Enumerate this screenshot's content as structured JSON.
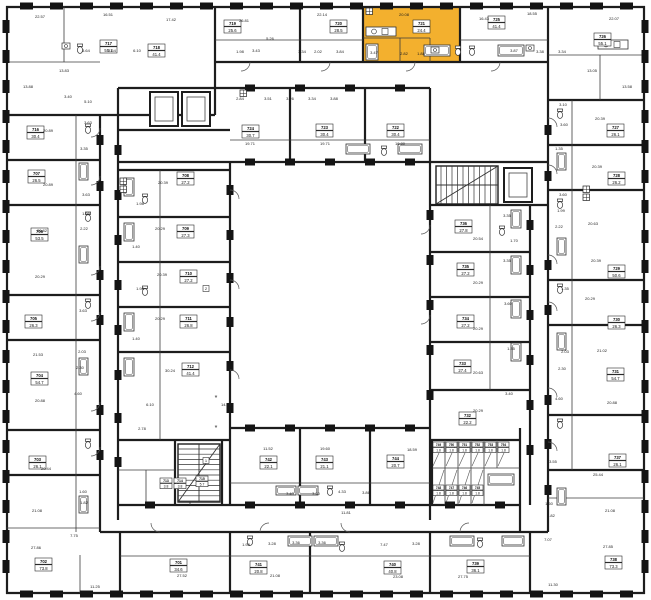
{
  "plan": {
    "type": "residential-floor-plan",
    "selected_unit": {
      "number": "721",
      "area": "24.4"
    },
    "colors": {
      "highlight": "#F3B02E",
      "wall": "#1d1d1d",
      "partition": "#3c3c3c",
      "pier": "#141414",
      "label_border": "#2a2a2a",
      "background": "#ffffff"
    },
    "units": [
      {
        "n": "717",
        "a": "55.1",
        "x": 100,
        "y": 40
      },
      {
        "n": "718",
        "a": "41.4",
        "x": 148,
        "y": 44
      },
      {
        "n": "719",
        "a": "25.6",
        "x": 224,
        "y": 20
      },
      {
        "n": "720",
        "a": "28.5",
        "x": 330,
        "y": 20
      },
      {
        "n": "721",
        "a": "24.4",
        "x": 413,
        "y": 20,
        "hl": 1
      },
      {
        "n": "725",
        "a": "41.4",
        "x": 488,
        "y": 16
      },
      {
        "n": "726",
        "a": "55.1",
        "x": 594,
        "y": 33
      },
      {
        "n": "727",
        "a": "26.1",
        "x": 607,
        "y": 124
      },
      {
        "n": "728",
        "a": "26.2",
        "x": 608,
        "y": 172
      },
      {
        "n": "729",
        "a": "50.6",
        "x": 608,
        "y": 265
      },
      {
        "n": "730",
        "a": "26.3",
        "x": 608,
        "y": 316
      },
      {
        "n": "731",
        "a": "54.7",
        "x": 607,
        "y": 368
      },
      {
        "n": "737",
        "a": "26.1",
        "x": 609,
        "y": 454
      },
      {
        "n": "738",
        "a": "73.3",
        "x": 605,
        "y": 556
      },
      {
        "n": "739",
        "a": "36.1",
        "x": 467,
        "y": 560
      },
      {
        "n": "740",
        "a": "40.8",
        "x": 384,
        "y": 561
      },
      {
        "n": "741",
        "a": "20.8",
        "x": 250,
        "y": 561
      },
      {
        "n": "701",
        "a": "34.6",
        "x": 170,
        "y": 559
      },
      {
        "n": "702",
        "a": "73.8",
        "x": 35,
        "y": 558
      },
      {
        "n": "703",
        "a": "26.1",
        "x": 29,
        "y": 456
      },
      {
        "n": "704",
        "a": "54.7",
        "x": 31,
        "y": 372
      },
      {
        "n": "705",
        "a": "26.3",
        "x": 25,
        "y": 315
      },
      {
        "n": "706",
        "a": "53.5",
        "x": 31,
        "y": 228
      },
      {
        "n": "707",
        "a": "26.5",
        "x": 28,
        "y": 170
      },
      {
        "n": "716",
        "a": "30.4",
        "x": 27,
        "y": 126
      },
      {
        "n": "724",
        "a": "30.7",
        "x": 242,
        "y": 125
      },
      {
        "n": "723",
        "a": "30.4",
        "x": 316,
        "y": 124
      },
      {
        "n": "722",
        "a": "30.4",
        "x": 387,
        "y": 124
      },
      {
        "n": "736",
        "a": "27.8",
        "x": 455,
        "y": 220
      },
      {
        "n": "735",
        "a": "27.2",
        "x": 457,
        "y": 263
      },
      {
        "n": "734",
        "a": "27.2",
        "x": 457,
        "y": 315
      },
      {
        "n": "733",
        "a": "27.4",
        "x": 454,
        "y": 360
      },
      {
        "n": "732",
        "a": "22.2",
        "x": 459,
        "y": 412
      },
      {
        "n": "708",
        "a": "27.2",
        "x": 177,
        "y": 172
      },
      {
        "n": "709",
        "a": "27.3",
        "x": 177,
        "y": 225
      },
      {
        "n": "710",
        "a": "27.2",
        "x": 180,
        "y": 270
      },
      {
        "n": "711",
        "a": "26.8",
        "x": 180,
        "y": 315
      },
      {
        "n": "712",
        "a": "41.4",
        "x": 182,
        "y": 363
      },
      {
        "n": "742",
        "a": "22.1",
        "x": 260,
        "y": 456
      },
      {
        "n": "743",
        "a": "21.1",
        "x": 316,
        "y": 456
      },
      {
        "n": "744",
        "a": "20.7",
        "x": 387,
        "y": 455
      },
      {
        "n": "713",
        "a": "3.8",
        "x": 160,
        "y": 478,
        "s": 1
      },
      {
        "n": "714",
        "a": "3.8",
        "x": 174,
        "y": 478,
        "s": 1
      },
      {
        "n": "715",
        "a": "5.7",
        "x": 196,
        "y": 476,
        "s": 1
      }
    ],
    "storage_units": [
      {
        "n": "749",
        "a": "1.8",
        "x": 433,
        "y": 442
      },
      {
        "n": "750",
        "a": "1.8",
        "x": 446,
        "y": 442
      },
      {
        "n": "751",
        "a": "1.8",
        "x": 459,
        "y": 442
      },
      {
        "n": "752",
        "a": "1.8",
        "x": 472,
        "y": 442
      },
      {
        "n": "753",
        "a": "1.8",
        "x": 485,
        "y": 442
      },
      {
        "n": "754",
        "a": "1.8",
        "x": 498,
        "y": 442
      },
      {
        "n": "748",
        "a": "1.8",
        "x": 433,
        "y": 485
      },
      {
        "n": "747",
        "a": "1.8",
        "x": 446,
        "y": 485
      },
      {
        "n": "746",
        "a": "1.8",
        "x": 459,
        "y": 485
      },
      {
        "n": "745",
        "a": "1.8",
        "x": 472,
        "y": 485
      }
    ],
    "rooms": [
      [
        "22.57",
        40,
        18
      ],
      [
        "16.51",
        108,
        16
      ],
      [
        "17.42",
        171,
        21
      ],
      [
        "26.81",
        244,
        22
      ],
      [
        "22.14",
        322,
        16
      ],
      [
        "20.08",
        404,
        16
      ],
      [
        "16.43",
        484,
        20
      ],
      [
        "18.55",
        532,
        15
      ],
      [
        "22.07",
        614,
        20
      ],
      [
        "13.83",
        64,
        72
      ],
      [
        "13.88",
        28,
        88
      ],
      [
        "3.40",
        68,
        98
      ],
      [
        "5.10",
        88,
        103
      ],
      [
        "3.64",
        86,
        52
      ],
      [
        "3.64",
        112,
        52
      ],
      [
        "6.10",
        137,
        52
      ],
      [
        "1.98",
        240,
        53
      ],
      [
        "3.43",
        256,
        52
      ],
      [
        "5.26",
        270,
        40
      ],
      [
        "3.34",
        302,
        53
      ],
      [
        "2.02",
        318,
        53
      ],
      [
        "3.84",
        340,
        53
      ],
      [
        "3.47",
        374,
        54
      ],
      [
        "2.82",
        404,
        55
      ],
      [
        "1.88",
        421,
        55
      ],
      [
        "3.87",
        514,
        52
      ],
      [
        "3.38",
        540,
        53
      ],
      [
        "3.34",
        562,
        53
      ],
      [
        "13.05",
        592,
        72
      ],
      [
        "13.58",
        627,
        88
      ],
      [
        "20.89",
        48,
        132
      ],
      [
        "20.89",
        48,
        186
      ],
      [
        "20.82",
        42,
        232
      ],
      [
        "20.29",
        40,
        278
      ],
      [
        "21.53",
        38,
        356
      ],
      [
        "20.88",
        40,
        402
      ],
      [
        "20.44",
        46,
        470
      ],
      [
        "21.08",
        37,
        512
      ],
      [
        "27.86",
        36,
        549
      ],
      [
        "11.25",
        95,
        588
      ],
      [
        "3.63",
        88,
        124
      ],
      [
        "3.35",
        84,
        150
      ],
      [
        "3.63",
        86,
        196
      ],
      [
        "1.99",
        86,
        215
      ],
      [
        "2.22",
        84,
        230
      ],
      [
        "3.63",
        83,
        312
      ],
      [
        "2.03",
        82,
        353
      ],
      [
        "2.30",
        80,
        369
      ],
      [
        "4.60",
        78,
        395
      ],
      [
        "1.60",
        83,
        493
      ],
      [
        "1.82",
        84,
        504
      ],
      [
        "7.75",
        74,
        537
      ],
      [
        "20.39",
        600,
        120
      ],
      [
        "20.39",
        597,
        168
      ],
      [
        "20.63",
        593,
        225
      ],
      [
        "20.39",
        596,
        262
      ],
      [
        "20.29",
        590,
        300
      ],
      [
        "21.02",
        602,
        352
      ],
      [
        "20.88",
        612,
        404
      ],
      [
        "25.44",
        598,
        476
      ],
      [
        "21.08",
        610,
        512
      ],
      [
        "27.85",
        608,
        548
      ],
      [
        "3.10",
        563,
        106
      ],
      [
        "3.60",
        564,
        126
      ],
      [
        "1.35",
        559,
        150
      ],
      [
        "3.60",
        563,
        196
      ],
      [
        "1.99",
        561,
        212
      ],
      [
        "2.22",
        559,
        228
      ],
      [
        "1.35",
        565,
        290
      ],
      [
        "2.03",
        565,
        353
      ],
      [
        "2.30",
        562,
        370
      ],
      [
        "4.60",
        559,
        400
      ],
      [
        "3.55",
        553,
        463
      ],
      [
        "1.60",
        549,
        505
      ],
      [
        "1.82",
        551,
        517
      ],
      [
        "7.07",
        548,
        541
      ],
      [
        "27.52",
        182,
        577
      ],
      [
        "21.08",
        275,
        577
      ],
      [
        "23.08",
        398,
        578
      ],
      [
        "27.75",
        463,
        578
      ],
      [
        "11.30",
        553,
        586
      ],
      [
        "11.81",
        346,
        514
      ],
      [
        "1.98",
        246,
        546
      ],
      [
        "3.28",
        272,
        545
      ],
      [
        "3.36",
        296,
        544
      ],
      [
        "3.36",
        322,
        544
      ],
      [
        "7.47",
        384,
        546
      ],
      [
        "3.28",
        416,
        545
      ],
      [
        "2.84",
        240,
        100
      ],
      [
        "3.51",
        268,
        100
      ],
      [
        "3.26",
        290,
        100
      ],
      [
        "3.34",
        312,
        100
      ],
      [
        "3.88",
        334,
        100
      ],
      [
        "19.71",
        250,
        145
      ],
      [
        "19.71",
        325,
        145
      ],
      [
        "19.80",
        400,
        145
      ],
      [
        "20.39",
        163,
        184
      ],
      [
        "20.29",
        160,
        230
      ],
      [
        "20.39",
        162,
        276
      ],
      [
        "20.29",
        160,
        320
      ],
      [
        "30.24",
        170,
        372
      ],
      [
        "1.98",
        140,
        205
      ],
      [
        "1.40",
        136,
        248
      ],
      [
        "1.98",
        140,
        290
      ],
      [
        "1.40",
        136,
        340
      ],
      [
        "6.10",
        150,
        406
      ],
      [
        "14.24",
        226,
        406
      ],
      [
        "2.78",
        142,
        430
      ],
      [
        "20.54",
        478,
        240
      ],
      [
        "20.29",
        478,
        284
      ],
      [
        "20.29",
        478,
        330
      ],
      [
        "20.63",
        478,
        374
      ],
      [
        "20.29",
        478,
        412
      ],
      [
        "3.35",
        507,
        217
      ],
      [
        "1.70",
        514,
        242
      ],
      [
        "3.35",
        507,
        262
      ],
      [
        "3.60",
        508,
        305
      ],
      [
        "1.35",
        511,
        350
      ],
      [
        "3.40",
        509,
        395
      ],
      [
        "11.52",
        268,
        450
      ],
      [
        "19.60",
        325,
        450
      ],
      [
        "18.59",
        412,
        451
      ],
      [
        "3.40",
        290,
        495
      ],
      [
        "3.40",
        316,
        495
      ],
      [
        "4.33",
        342,
        493
      ],
      [
        "3.86",
        366,
        494
      ]
    ],
    "wall_markers": [
      "2",
      "1"
    ],
    "stair_note": "*"
  }
}
